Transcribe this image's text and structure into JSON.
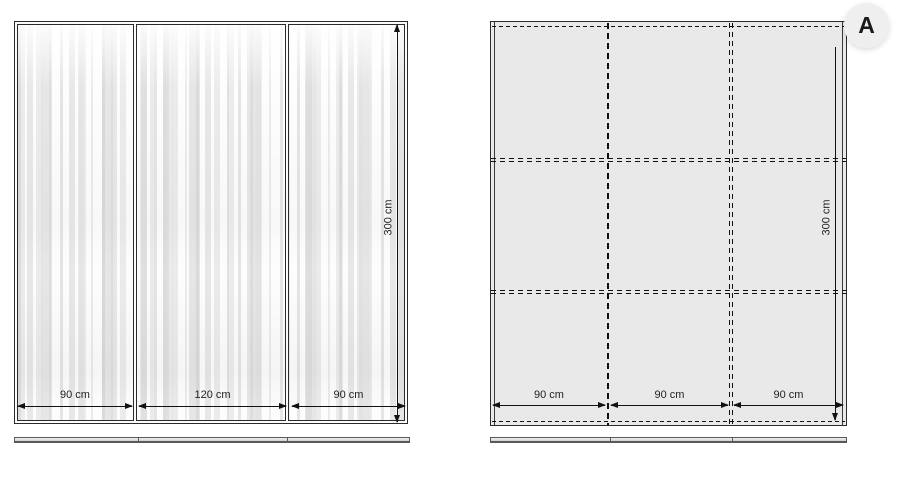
{
  "left_unit": {
    "width_labels": [
      "90 cm",
      "120 cm",
      "90 cm"
    ],
    "height_label": "300 cm"
  },
  "right_unit": {
    "badge_label": "A",
    "width_labels": [
      "90 cm",
      "90 cm",
      "90 cm"
    ],
    "height_label": "300 cm"
  },
  "colors": {
    "line": "#222222",
    "dash_line": "#111111",
    "right_panel_fill": "#e9e9e9",
    "badge_fill": "#efefef",
    "label_text": "#222222",
    "background": "#ffffff"
  }
}
